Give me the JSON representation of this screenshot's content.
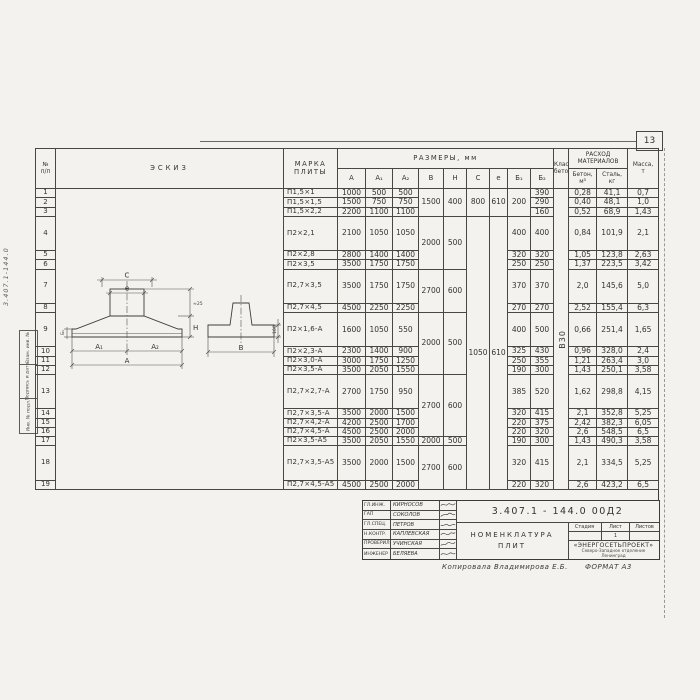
{
  "page": {
    "sheet_number": "13"
  },
  "margin": {
    "doc_number_vertical": "3.407.1-144.0",
    "stamps": [
      "Взам. инв. №",
      "Подпись и дата",
      "Инв. № подл."
    ]
  },
  "table": {
    "headers": {
      "num_line1": "№",
      "num_line2": "п/п",
      "sketch": "ЭСКИЗ",
      "mark_line1": "МАРКА",
      "mark_line2": "ПЛИТЫ",
      "dims_group": "РАЗМЕРЫ,  мм",
      "dims": [
        "А",
        "А₁",
        "А₂",
        "В",
        "Н",
        "С",
        "е",
        "Б₁",
        "Б₂"
      ],
      "class_line1": "Класс",
      "class_line2": "бетона",
      "cons_line1": "РАСХОД",
      "cons_line2": "МАТЕРИАЛОВ",
      "concrete_line1": "Бетон,",
      "concrete_line2": "м³",
      "steel_line1": "Сталь,",
      "steel_line2": "кг",
      "mass_line1": "Масса,",
      "mass_line2": "т"
    },
    "concrete_class": "В30",
    "rows": [
      {
        "n": "1",
        "mark": "П1,5×1",
        "a": "1000",
        "a1": "500",
        "a2": "500",
        "b": "1500",
        "h": "400",
        "c": "800",
        "e": "610",
        "b1": "200",
        "b2": "390",
        "concrete": "0,28",
        "steel": "41,1",
        "mass": "0,7"
      },
      {
        "n": "2",
        "mark": "П1,5×1,5",
        "a": "1500",
        "a1": "750",
        "a2": "750",
        "b2": "290",
        "concrete": "0,40",
        "steel": "48,1",
        "mass": "1,0"
      },
      {
        "n": "3",
        "mark": "П1,5×2,2",
        "a": "2200",
        "a1": "1100",
        "a2": "1100",
        "b2": "160",
        "concrete": "0,52",
        "steel": "68,9",
        "mass": "1,43"
      },
      {
        "n": "4",
        "mark": "П2×2,1",
        "a": "2100",
        "a1": "1050",
        "a2": "1050",
        "b": "2000",
        "h": "500",
        "c": "1050",
        "e": "610",
        "b1": "400",
        "b2": "400",
        "concrete": "0,84",
        "steel": "101,9",
        "mass": "2,1"
      },
      {
        "n": "5",
        "mark": "П2×2,8",
        "a": "2800",
        "a1": "1400",
        "a2": "1400",
        "b1": "320",
        "b2": "320",
        "concrete": "1,05",
        "steel": "123,8",
        "mass": "2,63"
      },
      {
        "n": "6",
        "mark": "П2×3,5",
        "a": "3500",
        "a1": "1750",
        "a2": "1750",
        "b1": "250",
        "b2": "250",
        "concrete": "1,37",
        "steel": "223,5",
        "mass": "3,42"
      },
      {
        "n": "7",
        "mark": "П2,7×3,5",
        "a": "3500",
        "a1": "1750",
        "a2": "1750",
        "b": "2700",
        "h": "600",
        "b1": "370",
        "b2": "370",
        "concrete": "2,0",
        "steel": "145,6",
        "mass": "5,0"
      },
      {
        "n": "8",
        "mark": "П2,7×4,5",
        "a": "4500",
        "a1": "2250",
        "a2": "2250",
        "b1": "270",
        "b2": "270",
        "concrete": "2,52",
        "steel": "155,4",
        "mass": "6,3"
      },
      {
        "n": "9",
        "mark": "П2×1,6-А",
        "a": "1600",
        "a1": "1050",
        "a2": "550",
        "b": "2000",
        "h": "500",
        "b1": "400",
        "b2": "500",
        "concrete": "0,66",
        "steel": "251,4",
        "mass": "1,65"
      },
      {
        "n": "10",
        "mark": "П2×2,3-А",
        "a": "2300",
        "a1": "1400",
        "a2": "900",
        "b1": "325",
        "b2": "430",
        "concrete": "0,96",
        "steel": "328,0",
        "mass": "2,4"
      },
      {
        "n": "11",
        "mark": "П2×3,0-А",
        "a": "3000",
        "a1": "1750",
        "a2": "1250",
        "b1": "250",
        "b2": "355",
        "concrete": "1,21",
        "steel": "263,4",
        "mass": "3,0"
      },
      {
        "n": "12",
        "mark": "П2×3,5-А",
        "a": "3500",
        "a1": "2050",
        "a2": "1550",
        "b1": "190",
        "b2": "300",
        "concrete": "1,43",
        "steel": "250,1",
        "mass": "3,58"
      },
      {
        "n": "13",
        "mark": "П2,7×2,7-А",
        "a": "2700",
        "a1": "1750",
        "a2": "950",
        "b": "2700",
        "h": "600",
        "b1": "385",
        "b2": "520",
        "concrete": "1,62",
        "steel": "298,8",
        "mass": "4,15"
      },
      {
        "n": "14",
        "mark": "П2,7×3,5-А",
        "a": "3500",
        "a1": "2000",
        "a2": "1500",
        "b1": "320",
        "b2": "415",
        "concrete": "2,1",
        "steel": "352,8",
        "mass": "5,25"
      },
      {
        "n": "15",
        "mark": "П2,7×4,2-А",
        "a": "4200",
        "a1": "2500",
        "a2": "1700",
        "b1": "220",
        "b2": "375",
        "concrete": "2,42",
        "steel": "382,3",
        "mass": "6,05"
      },
      {
        "n": "16",
        "mark": "П2,7×4,5-А",
        "a": "4500",
        "a1": "2500",
        "a2": "2000",
        "b1": "220",
        "b2": "320",
        "concrete": "2,6",
        "steel": "548,5",
        "mass": "6,5"
      },
      {
        "n": "17",
        "mark": "П2×3,5-А5",
        "a": "3500",
        "a1": "2050",
        "a2": "1550",
        "b": "2000",
        "h": "500",
        "b1": "190",
        "b2": "300",
        "concrete": "1,43",
        "steel": "490,3",
        "mass": "3,58"
      },
      {
        "n": "18",
        "mark": "П2,7×3,5-А5",
        "a": "3500",
        "a1": "2000",
        "a2": "1500",
        "b": "2700",
        "h": "600",
        "b1": "320",
        "b2": "415",
        "concrete": "2,1",
        "steel": "334,5",
        "mass": "5,25"
      },
      {
        "n": "19",
        "mark": "П2,7×4,5-А5",
        "a": "4500",
        "a1": "2500",
        "a2": "2000",
        "b1": "220",
        "b2": "320",
        "concrete": "2,6",
        "steel": "423,2",
        "mass": "6,5"
      }
    ]
  },
  "sketch": {
    "labels": {
      "c": "С",
      "e": "е",
      "a1": "А₁",
      "a2": "А₂",
      "a": "А",
      "h": "Н",
      "b1_small": "Б₁",
      "b2_small": "≈25",
      "b": "В",
      "edge": "100"
    }
  },
  "title_block": {
    "doc_number": "3.407.1 - 144.0    00Д2",
    "title_line1": "НОМЕНКЛАТУРА",
    "title_line2": "ПЛИТ",
    "stage_label": "Стадия",
    "sheet_label": "Лист",
    "sheets_label": "Листов",
    "stage_value": "",
    "sheet_value": "1",
    "sheets_value": "",
    "org_name": "«ЭНЕРГОСЕТЬПРОЕКТ»",
    "org_line2": "Северо-Западное отделение",
    "org_line3": "Ленинград",
    "signers": [
      {
        "role": "ГЛ.ИНЖ.",
        "name": "КИРНОСОВ"
      },
      {
        "role": "ГАП",
        "name": "СОКОЛОВ"
      },
      {
        "role": "ГЛ.СПЕЦ.",
        "name": "ПЕТРОВ"
      },
      {
        "role": "Н.КОНТР.",
        "name": "КАПЛЕВСКАЯ"
      },
      {
        "role": "ПРОВЕРИЛ",
        "name": "УЧИНСКАЯ"
      },
      {
        "role": "ИНЖЕНЕР",
        "name": "БЕЛЯЕВА"
      }
    ],
    "footer_note": "Копировала  Владимирова Е.Б.",
    "format_note": "ФОРМАТ А3"
  }
}
